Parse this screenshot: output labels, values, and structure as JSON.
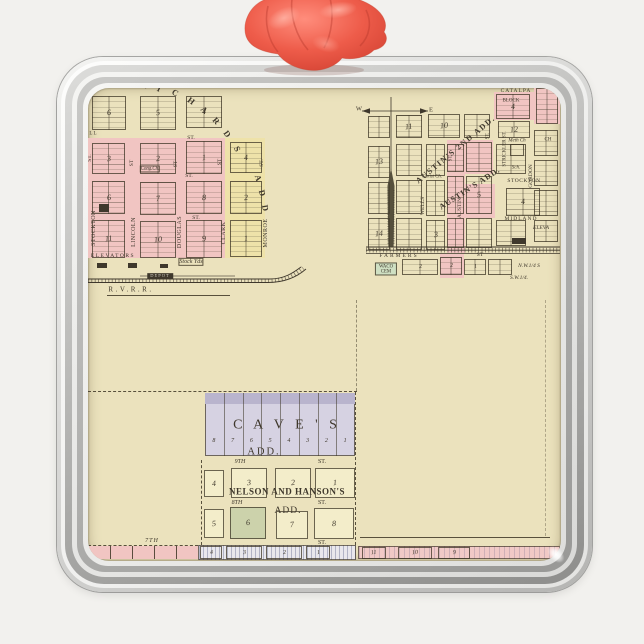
{
  "scene": {
    "background": "#f2f1ee",
    "frame_base": "#d9d9d7",
    "ribbon_main": "#ee5e4c",
    "ribbon_light": "#ff9e8e",
    "ribbon_dark": "#c03a2b",
    "paper": "#ebe2bd",
    "ink": "#3f382c"
  },
  "map": {
    "colors": {
      "paper": "#ebe2bd",
      "pink": "#f1c5c2",
      "yellow": "#eee2a9",
      "lav": "#d6d2e2",
      "lavband": "#b9b4cd",
      "green": "#ccd2ab",
      "cem": "#cfe0c3",
      "cream2": "#f3edca",
      "ink": "#3f382c",
      "hatch": "repeating-linear-gradient(90deg, rgba(90,95,135,.38) 0 1px, rgba(236,234,240,0) 1px 4px) #e9e7ec",
      "pinkhatch": "repeating-linear-gradient(90deg, rgba(120,110,140,.28) 0 1px, rgba(0,0,0,0) 1px 5px) #f1c9c6"
    },
    "areas": [
      {
        "x": 88,
        "y": 138,
        "w": 137,
        "h": 120,
        "f": "pink"
      },
      {
        "x": 225,
        "y": 138,
        "w": 40,
        "h": 120,
        "f": "yellow"
      },
      {
        "x": 447,
        "y": 140,
        "w": 18,
        "h": 113,
        "f": "pink"
      },
      {
        "x": 465,
        "y": 140,
        "w": 28,
        "h": 34,
        "f": "pink"
      },
      {
        "x": 465,
        "y": 184,
        "w": 30,
        "h": 34,
        "f": "pink"
      },
      {
        "x": 494,
        "y": 92,
        "w": 40,
        "h": 28,
        "f": "pink"
      },
      {
        "x": 534,
        "y": 86,
        "w": 26,
        "h": 38,
        "f": "pink"
      },
      {
        "x": 440,
        "y": 254,
        "w": 24,
        "h": 24,
        "f": "pink"
      },
      {
        "x": 205,
        "y": 393,
        "w": 150,
        "h": 63,
        "f": "lav"
      },
      {
        "x": 205,
        "y": 393,
        "w": 150,
        "h": 11,
        "f": "lavband"
      },
      {
        "x": 88,
        "y": 546,
        "w": 110,
        "h": 13,
        "f": "pink"
      },
      {
        "x": 198,
        "y": 545,
        "w": 158,
        "h": 15,
        "f": "hatch"
      },
      {
        "x": 358,
        "y": 546,
        "w": 202,
        "h": 13,
        "f": "pinkhatch"
      }
    ],
    "blocks": [
      {
        "x": 92,
        "y": 96,
        "w": 34,
        "h": 34,
        "n": "6"
      },
      {
        "x": 140,
        "y": 96,
        "w": 36,
        "h": 34,
        "n": "5"
      },
      {
        "x": 186,
        "y": 96,
        "w": 36,
        "h": 32,
        "n": "4"
      },
      {
        "x": 92,
        "y": 143,
        "w": 33,
        "h": 31,
        "n": "3"
      },
      {
        "x": 140,
        "y": 143,
        "w": 36,
        "h": 31,
        "n": "2"
      },
      {
        "x": 186,
        "y": 141,
        "w": 36,
        "h": 33,
        "n": "1"
      },
      {
        "x": 92,
        "y": 181,
        "w": 33,
        "h": 33,
        "n": "6"
      },
      {
        "x": 140,
        "y": 182,
        "w": 36,
        "h": 33,
        "n": "7"
      },
      {
        "x": 186,
        "y": 181,
        "w": 36,
        "h": 33,
        "n": "8"
      },
      {
        "x": 92,
        "y": 220,
        "w": 33,
        "h": 38,
        "n": "11"
      },
      {
        "x": 140,
        "y": 221,
        "w": 36,
        "h": 37,
        "n": "10"
      },
      {
        "x": 186,
        "y": 220,
        "w": 36,
        "h": 38,
        "n": "9"
      },
      {
        "x": 230,
        "y": 142,
        "w": 32,
        "h": 31,
        "n": "4"
      },
      {
        "x": 230,
        "y": 181,
        "w": 32,
        "h": 33,
        "n": "2"
      },
      {
        "x": 230,
        "y": 220,
        "w": 32,
        "h": 37,
        "n": "1"
      },
      {
        "x": 368,
        "y": 116,
        "w": 22,
        "h": 22,
        "n": ""
      },
      {
        "x": 396,
        "y": 115,
        "w": 26,
        "h": 23,
        "n": "11"
      },
      {
        "x": 428,
        "y": 114,
        "w": 32,
        "h": 24,
        "n": "10"
      },
      {
        "x": 464,
        "y": 114,
        "w": 26,
        "h": 24,
        "n": ""
      },
      {
        "x": 498,
        "y": 121,
        "w": 32,
        "h": 17,
        "n": "12"
      },
      {
        "x": 496,
        "y": 94,
        "w": 34,
        "h": 25,
        "n": "4"
      },
      {
        "x": 536,
        "y": 88,
        "w": 22,
        "h": 36,
        "n": ""
      },
      {
        "x": 368,
        "y": 146,
        "w": 22,
        "h": 32,
        "n": "13"
      },
      {
        "x": 396,
        "y": 144,
        "w": 26,
        "h": 32,
        "n": ""
      },
      {
        "x": 426,
        "y": 144,
        "w": 19,
        "h": 32,
        "n": ""
      },
      {
        "x": 447,
        "y": 144,
        "w": 17,
        "h": 28,
        "n": ""
      },
      {
        "x": 466,
        "y": 142,
        "w": 26,
        "h": 30,
        "n": ""
      },
      {
        "x": 496,
        "y": 144,
        "w": 30,
        "h": 30,
        "n": ""
      },
      {
        "x": 368,
        "y": 182,
        "w": 22,
        "h": 32,
        "n": ""
      },
      {
        "x": 396,
        "y": 180,
        "w": 26,
        "h": 34,
        "n": ""
      },
      {
        "x": 426,
        "y": 180,
        "w": 19,
        "h": 36,
        "n": ""
      },
      {
        "x": 447,
        "y": 176,
        "w": 17,
        "h": 38,
        "n": ""
      },
      {
        "x": 466,
        "y": 176,
        "w": 26,
        "h": 38,
        "n": "5"
      },
      {
        "x": 506,
        "y": 188,
        "w": 34,
        "h": 28,
        "n": "4"
      },
      {
        "x": 368,
        "y": 218,
        "w": 22,
        "h": 32,
        "n": "14"
      },
      {
        "x": 396,
        "y": 218,
        "w": 26,
        "h": 32,
        "n": ""
      },
      {
        "x": 426,
        "y": 220,
        "w": 19,
        "h": 30,
        "n": "3"
      },
      {
        "x": 447,
        "y": 218,
        "w": 17,
        "h": 30,
        "n": ""
      },
      {
        "x": 466,
        "y": 218,
        "w": 26,
        "h": 30,
        "n": ""
      },
      {
        "x": 496,
        "y": 220,
        "w": 30,
        "h": 26,
        "n": ""
      },
      {
        "x": 534,
        "y": 130,
        "w": 24,
        "h": 26,
        "n": ""
      },
      {
        "x": 534,
        "y": 160,
        "w": 24,
        "h": 26,
        "n": ""
      },
      {
        "x": 534,
        "y": 190,
        "w": 24,
        "h": 26,
        "n": ""
      },
      {
        "x": 534,
        "y": 220,
        "w": 24,
        "h": 22,
        "n": ""
      },
      {
        "x": 510,
        "y": 144,
        "w": 14,
        "h": 12,
        "n": "",
        "l": 0
      },
      {
        "x": 402,
        "y": 259,
        "w": 36,
        "h": 16,
        "n": "2",
        "ns": 6
      },
      {
        "x": 440,
        "y": 257,
        "w": 22,
        "h": 18,
        "n": "2",
        "ns": 6
      },
      {
        "x": 464,
        "y": 259,
        "w": 22,
        "h": 16,
        "n": "1",
        "ns": 6
      },
      {
        "x": 488,
        "y": 259,
        "w": 24,
        "h": 16,
        "n": "",
        "ns": 6
      },
      {
        "x": 204,
        "y": 470,
        "w": 20,
        "h": 27,
        "n": "4",
        "f": "cream2",
        "l": 0
      },
      {
        "x": 231,
        "y": 468,
        "w": 36,
        "h": 30,
        "n": "3",
        "f": "cream2",
        "l": 0
      },
      {
        "x": 275,
        "y": 468,
        "w": 36,
        "h": 30,
        "n": "2",
        "f": "cream2",
        "l": 0
      },
      {
        "x": 315,
        "y": 468,
        "w": 40,
        "h": 30,
        "n": "1",
        "f": "cream2",
        "l": 0
      },
      {
        "x": 204,
        "y": 509,
        "w": 20,
        "h": 29,
        "n": "5",
        "f": "cream2",
        "l": 0
      },
      {
        "x": 230,
        "y": 507,
        "w": 36,
        "h": 32,
        "n": "6",
        "f": "green",
        "l": 0
      },
      {
        "x": 276,
        "y": 511,
        "w": 32,
        "h": 28,
        "n": "7",
        "f": "cream2",
        "l": 0
      },
      {
        "x": 314,
        "y": 508,
        "w": 40,
        "h": 31,
        "n": "8",
        "f": "cream2",
        "l": 0
      },
      {
        "x": 200,
        "y": 546,
        "w": 22,
        "h": 13,
        "n": "4",
        "ns": 6,
        "l": 0
      },
      {
        "x": 226,
        "y": 546,
        "w": 36,
        "h": 13,
        "n": "3",
        "ns": 6,
        "l": 0
      },
      {
        "x": 266,
        "y": 546,
        "w": 36,
        "h": 13,
        "n": "2",
        "ns": 6,
        "l": 0
      },
      {
        "x": 306,
        "y": 546,
        "w": 24,
        "h": 13,
        "n": "1",
        "ns": 6,
        "l": 0
      },
      {
        "x": 362,
        "y": 547,
        "w": 24,
        "h": 12,
        "n": "11",
        "ns": 6,
        "l": 0
      },
      {
        "x": 398,
        "y": 547,
        "w": 34,
        "h": 12,
        "n": "10",
        "ns": 6,
        "l": 0
      },
      {
        "x": 438,
        "y": 547,
        "w": 32,
        "h": 12,
        "n": "9",
        "ns": 6,
        "l": 0
      },
      {
        "x": 97,
        "y": 263,
        "w": 10,
        "h": 5,
        "n": "",
        "f": "ink",
        "l": 0
      },
      {
        "x": 128,
        "y": 263,
        "w": 9,
        "h": 5,
        "n": "",
        "f": "ink",
        "l": 0
      },
      {
        "x": 160,
        "y": 264,
        "w": 8,
        "h": 4,
        "n": "",
        "f": "ink",
        "l": 0
      },
      {
        "x": 99,
        "y": 204,
        "w": 10,
        "h": 8,
        "n": "",
        "f": "ink",
        "l": 0
      },
      {
        "x": 512,
        "y": 238,
        "w": 14,
        "h": 6,
        "n": "",
        "f": "ink",
        "l": 0
      }
    ],
    "labels": [
      {
        "t": "R",
        "x": 144,
        "y": 85,
        "r": 20,
        "s": 8.5,
        "b": 1
      },
      {
        "t": "I",
        "x": 159,
        "y": 89,
        "r": 25,
        "s": 8.5,
        "b": 1
      },
      {
        "t": "C",
        "x": 175,
        "y": 93,
        "r": 30,
        "s": 8.5,
        "b": 1
      },
      {
        "t": "H",
        "x": 191,
        "y": 101,
        "r": 36,
        "s": 8.5,
        "b": 1
      },
      {
        "t": "A",
        "x": 204,
        "y": 110,
        "r": 42,
        "s": 8.5,
        "b": 1
      },
      {
        "t": "R",
        "x": 216,
        "y": 121,
        "r": 48,
        "s": 8.5,
        "b": 1
      },
      {
        "t": "D",
        "x": 227,
        "y": 134,
        "r": 55,
        "s": 8.5,
        "b": 1
      },
      {
        "t": "S",
        "x": 237,
        "y": 149,
        "r": 62,
        "s": 8.5,
        "b": 1
      },
      {
        "t": "A",
        "x": 258,
        "y": 178,
        "r": 72,
        "s": 8.5,
        "b": 1
      },
      {
        "t": "D",
        "x": 262,
        "y": 193,
        "r": 76,
        "s": 8.5,
        "b": 1
      },
      {
        "t": "D",
        "x": 265,
        "y": 208,
        "r": 80,
        "s": 8.5,
        "b": 1
      },
      {
        "t": "STOCKTON",
        "x": 94,
        "y": 228,
        "r": -90,
        "s": 6,
        "ls": 0.5
      },
      {
        "t": "LINCOLN",
        "x": 134,
        "y": 232,
        "r": -90,
        "s": 6,
        "ls": 0.5
      },
      {
        "t": "DOUGLAS",
        "x": 180,
        "y": 232,
        "r": -90,
        "s": 6,
        "ls": 0.5
      },
      {
        "t": "CLARK",
        "x": 224,
        "y": 233,
        "r": -90,
        "s": 6,
        "ls": 0.5
      },
      {
        "t": "MONROE",
        "x": 266,
        "y": 233,
        "r": -90,
        "s": 6,
        "ls": 0.5
      },
      {
        "t": "ST.",
        "x": 91,
        "y": 158,
        "r": -90,
        "s": 5.5
      },
      {
        "t": "ST",
        "x": 133,
        "y": 163,
        "r": -90,
        "s": 5.5
      },
      {
        "t": "ST",
        "x": 177,
        "y": 164,
        "r": -90,
        "s": 5.5
      },
      {
        "t": "ST",
        "x": 221,
        "y": 162,
        "r": -90,
        "s": 5.5
      },
      {
        "t": "ST.",
        "x": 263,
        "y": 163,
        "r": -90,
        "s": 5.5
      },
      {
        "t": "ST.",
        "x": 191,
        "y": 139,
        "s": 5.5
      },
      {
        "t": "ST.",
        "x": 189,
        "y": 177,
        "s": 5.5
      },
      {
        "t": "ST.",
        "x": 196,
        "y": 219,
        "s": 5.5
      },
      {
        "t": "L L",
        "x": 93,
        "y": 134,
        "s": 5
      },
      {
        "t": "Cong.Ch.",
        "x": 150,
        "y": 169,
        "s": 4.8,
        "i": 1,
        "bx": 1
      },
      {
        "t": "ELEVATORS",
        "x": 113,
        "y": 257,
        "s": 5.5,
        "ls": 1.5
      },
      {
        "t": "Stock Yds",
        "x": 191,
        "y": 262,
        "s": 6,
        "i": 1,
        "bx": 1
      },
      {
        "t": "DEPOT",
        "x": 160,
        "y": 276,
        "s": 4.5,
        "bg": "ink",
        "c": "#eae6da",
        "ls": 1
      },
      {
        "t": "R.V.R.R.",
        "x": 131,
        "y": 290,
        "s": 7,
        "ls": 2.5
      },
      {
        "t": "W",
        "x": 359,
        "y": 110,
        "s": 6.5
      },
      {
        "t": "E",
        "x": 431,
        "y": 111,
        "s": 6.5
      },
      {
        "t": "AUSTIN'S 2ND ADD.",
        "x": 456,
        "y": 150,
        "r": -40,
        "s": 8,
        "b": 1,
        "ls": 1.5
      },
      {
        "t": "AUSTIN'S ADD.",
        "x": 470,
        "y": 189,
        "r": -33,
        "s": 8,
        "b": 1,
        "ls": 1
      },
      {
        "t": "WELLS",
        "x": 424,
        "y": 206,
        "r": -90,
        "s": 5.5
      },
      {
        "t": "AUSTIN",
        "x": 461,
        "y": 208,
        "r": -90,
        "s": 5.5
      },
      {
        "t": "ST.",
        "x": 451,
        "y": 158,
        "r": -90,
        "s": 5
      },
      {
        "t": "ST.",
        "x": 488,
        "y": 136,
        "r": -90,
        "s": 5
      },
      {
        "t": "STRICKLER ST.",
        "x": 505,
        "y": 149,
        "r": -90,
        "s": 5
      },
      {
        "t": "GORDON",
        "x": 532,
        "y": 176,
        "r": -90,
        "s": 5.5
      },
      {
        "t": "CATALPA",
        "x": 516,
        "y": 92,
        "s": 5.5,
        "ls": 1
      },
      {
        "t": "BLOCK",
        "x": 511,
        "y": 101,
        "s": 5
      },
      {
        "t": "Meth Ch",
        "x": 517,
        "y": 141,
        "s": 5,
        "i": 1
      },
      {
        "t": "CH",
        "x": 548,
        "y": 140,
        "s": 5
      },
      {
        "t": "Sch.",
        "x": 516,
        "y": 168,
        "s": 5,
        "i": 1
      },
      {
        "t": "STOCKTON",
        "x": 524,
        "y": 182,
        "s": 5.5,
        "ls": 0.5
      },
      {
        "t": "MIDLAND",
        "x": 521,
        "y": 220,
        "s": 5.5,
        "ls": 1
      },
      {
        "t": "ELEVA",
        "x": 541,
        "y": 229,
        "s": 5.5,
        "i": 1
      },
      {
        "t": "Christ Ch.",
        "x": 432,
        "y": 177,
        "s": 4.8,
        "i": 1
      },
      {
        "t": "FARMERS",
        "x": 399,
        "y": 257,
        "s": 5.5,
        "ls": 2
      },
      {
        "t": "ST",
        "x": 480,
        "y": 256,
        "s": 5.5
      },
      {
        "t": "WACO\nCEM",
        "x": 386,
        "y": 269,
        "s": 4.8,
        "bg": "cem",
        "bx": 1
      },
      {
        "t": "N.W.1/4 S",
        "x": 529,
        "y": 267,
        "s": 5.5,
        "i": 1
      },
      {
        "t": "S.W.1/4.",
        "x": 519,
        "y": 279,
        "s": 5.5,
        "i": 1
      },
      {
        "t": "C A V E ' S",
        "x": 287,
        "y": 426,
        "s": 14,
        "ls": 4
      },
      {
        "t": "ADD.",
        "x": 264,
        "y": 452,
        "s": 10.5,
        "ls": 2
      },
      {
        "t": "9TH",
        "x": 240,
        "y": 462,
        "s": 6,
        "i": 1
      },
      {
        "t": "ST.",
        "x": 322,
        "y": 462,
        "s": 6
      },
      {
        "t": "NELSON AND HANSON'S",
        "x": 287,
        "y": 492,
        "s": 9,
        "b": 1,
        "ls": 0.5
      },
      {
        "t": "8TH",
        "x": 237,
        "y": 503,
        "s": 6,
        "i": 1
      },
      {
        "t": "ST.",
        "x": 322,
        "y": 503,
        "s": 6
      },
      {
        "t": "ADD.",
        "x": 288,
        "y": 512,
        "s": 9.5,
        "ls": 1
      },
      {
        "t": "ST.",
        "x": 322,
        "y": 543,
        "s": 6
      },
      {
        "t": "7TH",
        "x": 152,
        "y": 541,
        "s": 6,
        "i": 1,
        "ls": 1
      }
    ],
    "caves": {
      "x": 205,
      "y": 393,
      "w": 150,
      "h": 63,
      "strips": 8,
      "lot_numbers": [
        "8",
        "7",
        "6",
        "5",
        "4",
        "3",
        "2",
        "1"
      ],
      "lot_y": 441
    },
    "lines": [
      {
        "x1": 107,
        "y1": 295,
        "x2": 230,
        "y2": 295
      },
      {
        "x1": 88,
        "y1": 391,
        "x2": 357,
        "y2": 391,
        "d": 1
      },
      {
        "x1": 356,
        "y1": 300,
        "x2": 356,
        "y2": 391,
        "d": 1,
        "o": 0.5
      },
      {
        "x1": 355,
        "y1": 392,
        "x2": 355,
        "y2": 545,
        "d": 1
      },
      {
        "x1": 201,
        "y1": 460,
        "x2": 201,
        "y2": 545,
        "d": 1
      },
      {
        "x1": 360,
        "y1": 537,
        "x2": 550,
        "y2": 537
      },
      {
        "x1": 88,
        "y1": 545,
        "x2": 198,
        "y2": 545,
        "d": 1
      },
      {
        "x1": 84,
        "y1": 262,
        "x2": 84,
        "y2": 330,
        "o": 0.5
      },
      {
        "x1": 545,
        "y1": 300,
        "x2": 545,
        "y2": 536,
        "d": 1,
        "o": 0.35
      },
      {
        "x1": 110,
        "y1": 546,
        "x2": 110,
        "y2": 559
      },
      {
        "x1": 132,
        "y1": 546,
        "x2": 132,
        "y2": 559
      },
      {
        "x1": 154,
        "y1": 546,
        "x2": 154,
        "y2": 559
      },
      {
        "x1": 176,
        "y1": 546,
        "x2": 176,
        "y2": 559
      }
    ]
  }
}
